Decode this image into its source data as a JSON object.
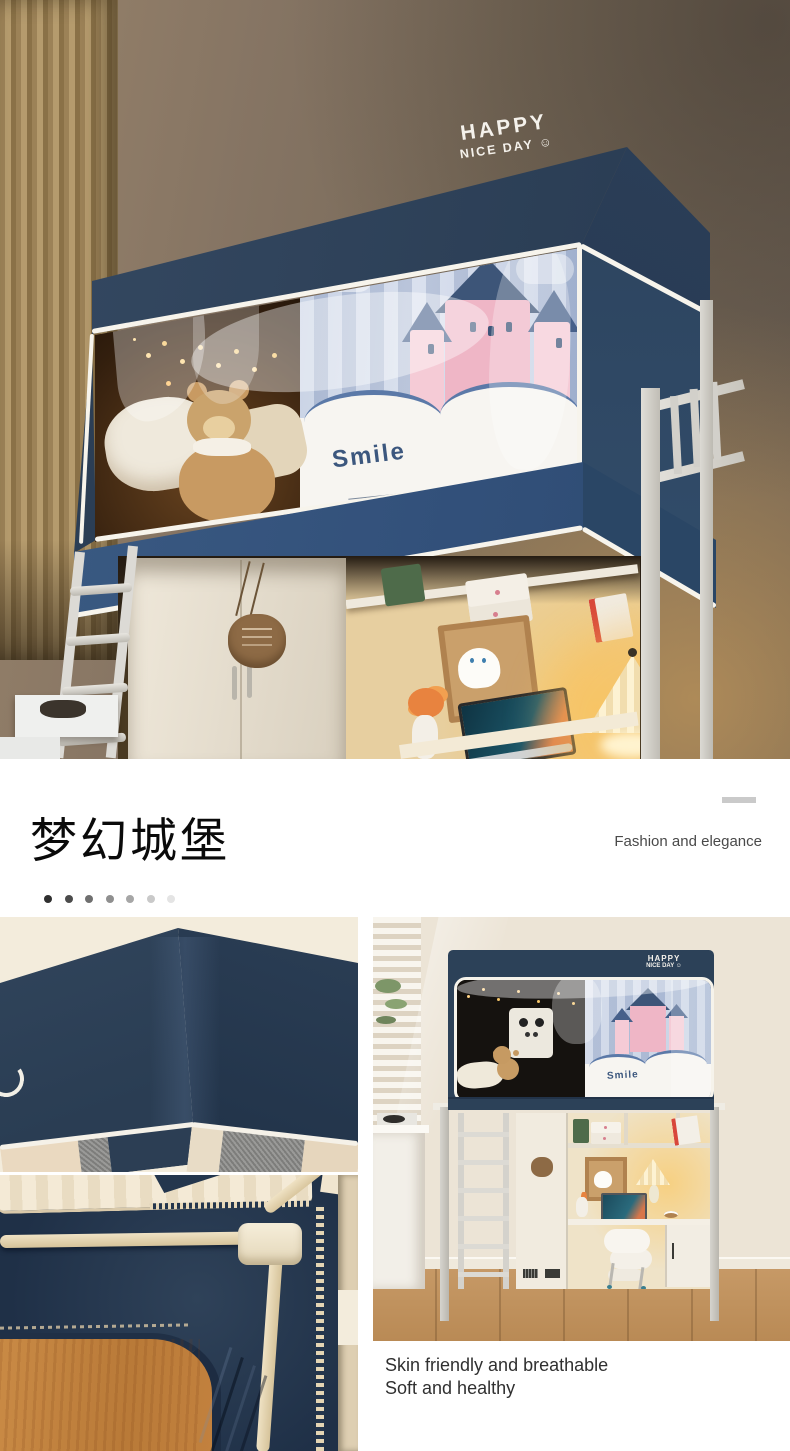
{
  "hero": {
    "brand_line1": "HAPPY",
    "brand_line2": "NICE DAY",
    "smiley": "☺",
    "curtain_text": "Smile"
  },
  "title_section": {
    "title": "梦幻城堡",
    "subtitle": "Fashion and elegance"
  },
  "pagination_dots": {
    "styles": [
      "background:#2f2f2f",
      "background:#4b4b4b",
      "background:#6f6f6f",
      "background:#8f8f8f",
      "background:#a6a6a6",
      "background:#c9c9c9",
      "background:#e4e4e4"
    ]
  },
  "gallery": {
    "room_photo": {
      "brand_line1": "HAPPY",
      "brand_line2": "NICE DAY ☺",
      "curtain_text": "Smile"
    },
    "caption_line1": "Skin friendly and breathable",
    "caption_line2": "Soft and healthy"
  },
  "colors": {
    "tent_navy": "#2c4158",
    "piping_white": "#f7f4ec",
    "castle_pink": "#efb6c6",
    "castle_roof_navy": "#3d5578",
    "divider_gray": "#cacaca",
    "wood": "#c2813e",
    "wall_beige": "#ece4d6",
    "warm_glow": "#f7c66a"
  }
}
